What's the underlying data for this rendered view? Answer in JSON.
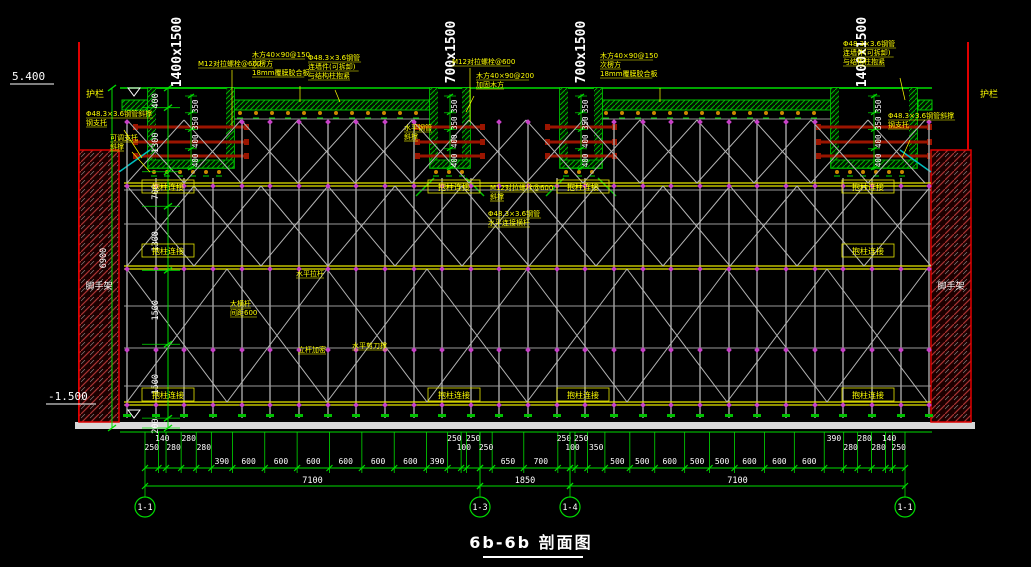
{
  "title": "6b-6b 剖面图",
  "elevations": {
    "top": "5.400",
    "bottom": "-1.500"
  },
  "side_labels": {
    "guardrail": "护栏",
    "scaffold": "脚手架"
  },
  "beam_size_labels": [
    "1400x1500",
    "700x1500",
    "700x1500",
    "1400x1500"
  ],
  "left_dim": {
    "segments": [
      "400",
      "1300",
      "700",
      "1300",
      "1500",
      "1500",
      "200"
    ],
    "overall": "6900"
  },
  "beam_dim_segments": [
    "350",
    "350",
    "400",
    "400"
  ],
  "boxed_label": "抱柱连接",
  "annotations": {
    "tie_bolt": "M12对拉螺栓@600",
    "joist150": "木方40×90@150",
    "secondary": "次楞方",
    "plywood": "18mm覆膜胶合板",
    "wall_tie_pipe": "Φ48.3×3.6钢管",
    "wall_tie_detach": "连墙件(可拆卸)",
    "wall_tie_hug": "与结构柱抱紧",
    "brace_pipe": "Φ48.3×3.6钢管斜撑",
    "steel_support": "钢支托",
    "adj_support": "可调支托",
    "diag_brace": "斜撑",
    "joist200": "木方40×90@200",
    "reinforce": "加固木方",
    "horiz_pipe": "水平钢管",
    "horiz_tie": "水平拉杆",
    "ledger": "大横杆",
    "ledger_spacing": "间距600",
    "post_dense": "立杆加密",
    "horiz_shear": "水平剪刀撑",
    "horiz_connect": "水平连接横杆"
  },
  "bottom_dims": {
    "groups": [
      {
        "segments": [
          "250",
          "140",
          "280",
          "280",
          "280",
          "390",
          "600",
          "600",
          "600",
          "600",
          "600",
          "600",
          "390",
          "250",
          "100",
          "250"
        ],
        "total": "7100"
      },
      {
        "segments": [
          "250",
          "650",
          "700",
          "250"
        ],
        "total": "1850"
      },
      {
        "segments": [
          "100",
          "250",
          "350",
          "500",
          "500",
          "600",
          "500",
          "500",
          "600",
          "600",
          "600",
          "390",
          "280",
          "280",
          "280",
          "140",
          "250"
        ],
        "total": "7100"
      }
    ],
    "axes": [
      "1-1",
      "1-3",
      "1-4",
      "1-1"
    ]
  }
}
